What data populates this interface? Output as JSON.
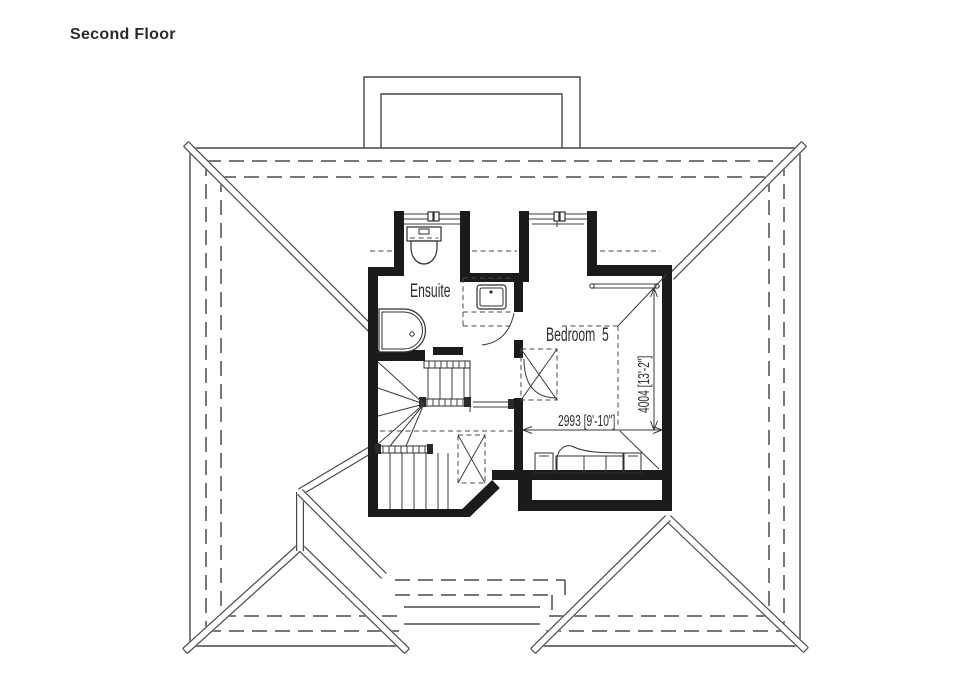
{
  "title": "Second Floor",
  "plan": {
    "labels": {
      "ensuite": "Ensuite",
      "bedroom": "Bedroom  5"
    },
    "dims": {
      "width": "2993 [9'-10\"]",
      "depth": "4004 [13'-2\"]"
    },
    "rooms": [
      {
        "name": "Ensuite"
      },
      {
        "name": "Bedroom 5",
        "width_mm": 2993,
        "width_imperial": "9'-10\"",
        "depth_mm": 4004,
        "depth_imperial": "13'-2\""
      }
    ],
    "features": [
      "hipped-roof-outline",
      "chimney",
      "two-dormer-windows",
      "winder-staircase",
      "toilet",
      "basin",
      "shower-tray",
      "double-bed",
      "bedside-tables",
      "wardrobe-rail",
      "door-swings",
      "rooflight-hatches"
    ],
    "colors": {
      "background": "#ffffff",
      "wall": "#1b1b1b",
      "roof_line": "#474747",
      "text": "#2d2d2d"
    }
  }
}
